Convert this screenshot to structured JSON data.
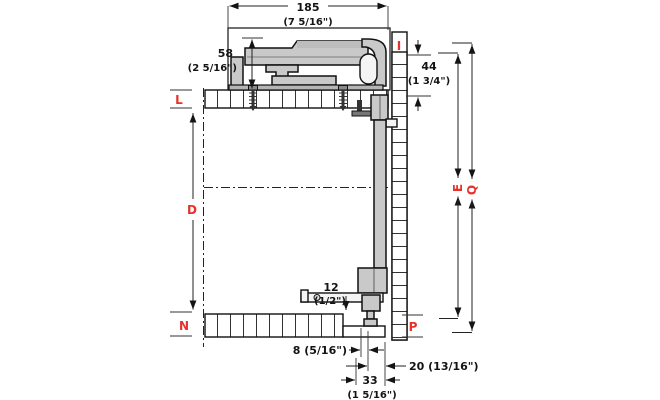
{
  "drawing": {
    "type": "technical-cross-section",
    "subject": "cabinet sliding-door fitting, side section with mounting dimensions",
    "dims": {
      "d185": {
        "mm": "185",
        "inch": "(7 5/16\")"
      },
      "d58": {
        "mm": "58",
        "inch": "(2 5/16\")"
      },
      "d44": {
        "mm": "44",
        "inch": "(1 3/4\")"
      },
      "d12": {
        "mm": "12",
        "inch": "(1/2\")"
      },
      "d8": {
        "text": "8 (5/16\")"
      },
      "d20": {
        "text": "20 (13/16\")"
      },
      "d33": {
        "mm": "33",
        "inch": "(1 5/16\")"
      }
    },
    "ref_labels": {
      "top_right": "I",
      "top_left": "L",
      "mid_left": "D",
      "bottom_left": "N",
      "bottom_right": "P",
      "height_e": "E",
      "height_q": "Q"
    },
    "colors": {
      "ref_red": "#e8312a",
      "line_black": "#141414",
      "metal_gray": "#c9c9c9",
      "metal_dark": "#b5b5b5",
      "background": "#ffffff"
    }
  }
}
